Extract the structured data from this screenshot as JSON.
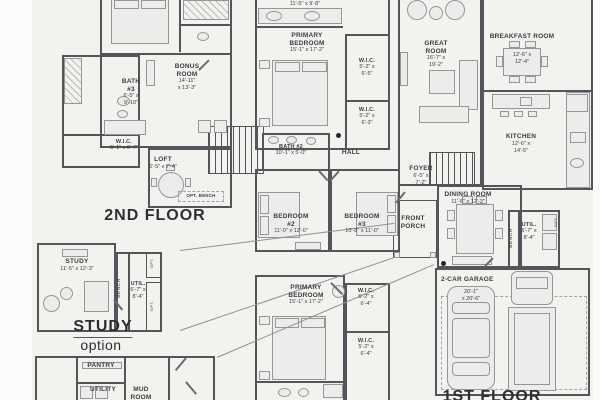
{
  "colors": {
    "background": "#f3f2ef",
    "wall": "#54555b",
    "text": "#3c3d41",
    "furniture_fill": "#edecea",
    "furniture_stroke": "#96969a",
    "connector": "#909094"
  },
  "second_floor": {
    "caption": "2ND FLOOR",
    "rooms": {
      "bath3": {
        "name": "BATH\n#3",
        "dims": "6'-5\" x\n9'-10\""
      },
      "bonus": {
        "name": "BONUS\nROOM",
        "dims": "14'-11\"\nx 13'-3\""
      },
      "wic": {
        "name": "W.I.C.",
        "dims": "5'-1\" x 6'-7\""
      },
      "loft": {
        "name": "LOFT",
        "dims": "6'-5\" x 7'-4\""
      },
      "opt_bench": {
        "name": "OPT. BENCH"
      }
    }
  },
  "study_option": {
    "caption": "STUDY",
    "caption_sub": "option",
    "rooms": {
      "study": {
        "name": "STUDY",
        "dims": "11'-5\" x 12'-3\""
      },
      "util": {
        "name": "UTIL.",
        "dims": "6'-7\" x\n8'-4\""
      },
      "bench": {
        "name": "BENCH"
      },
      "opt_top": {
        "name": "OPT."
      },
      "opt_bottom": {
        "name": "OPT."
      }
    }
  },
  "mud_option": {
    "rooms": {
      "pantry": {
        "name": "PANTRY"
      },
      "utility": {
        "name": "UTILITY"
      },
      "mud": {
        "name": "MUD\nROOM"
      }
    }
  },
  "first_floor": {
    "caption": "1ST FLOOR",
    "rooms": {
      "primary_bath": {
        "dims": "11'-5\" x 9'-8\""
      },
      "primary_bedroom": {
        "name": "PRIMARY\nBEDROOM",
        "dims": "15'-1\" x 17'-2\""
      },
      "wic1": {
        "name": "W.I.C.",
        "dims": "5'-2\" x\n6'-5\""
      },
      "wic2": {
        "name": "W.I.C.",
        "dims": "5'-2\" x\n6'-3\""
      },
      "bath2": {
        "name": "BATH #2",
        "dims": "10'-1\" x 5'-0\""
      },
      "hall": {
        "name": "HALL"
      },
      "bedroom2": {
        "name": "BEDROOM\n#2",
        "dims": "11'-0\" x 12'-0\""
      },
      "bedroom3": {
        "name": "BEDROOM\n#3",
        "dims": "10'-8\" x 11'-0\""
      },
      "great_room": {
        "name": "GREAT\nROOM",
        "dims": "16'-7\" x\n19'-2\""
      },
      "breakfast": {
        "name": "BREAKFAST ROOM",
        "dims": "12'-6\" x\n12'-4\""
      },
      "kitchen": {
        "name": "KITCHEN",
        "dims": "12'-6\" x\n14'-5\""
      },
      "foyer": {
        "name": "FOYER",
        "dims": "6'-5\" x\n7'-2\""
      },
      "dining": {
        "name": "DINING ROOM",
        "dims": "11'-6\" x 12'-3\""
      },
      "front_porch": {
        "name": "FRONT\nPORCH"
      },
      "util": {
        "name": "UTIL.",
        "dims": "6'-7\" x\n8'-4\""
      },
      "bench": {
        "name": "BENCH"
      },
      "util_opt": {
        "name": "OPT."
      },
      "garage": {
        "name": "2-CAR GARAGE",
        "dims": "20'-1\"\nx 20'-6\""
      }
    }
  },
  "primary_option": {
    "rooms": {
      "primary_bedroom": {
        "name": "PRIMARY\nBEDROOM",
        "dims": "15'-1\" x 17'-2\""
      },
      "wic1": {
        "name": "W.I.C.",
        "dims": "5'-2\" x\n6'-4\""
      },
      "wic2": {
        "name": "W.I.C.",
        "dims": "5'-2\" x\n6'-4\""
      }
    }
  }
}
